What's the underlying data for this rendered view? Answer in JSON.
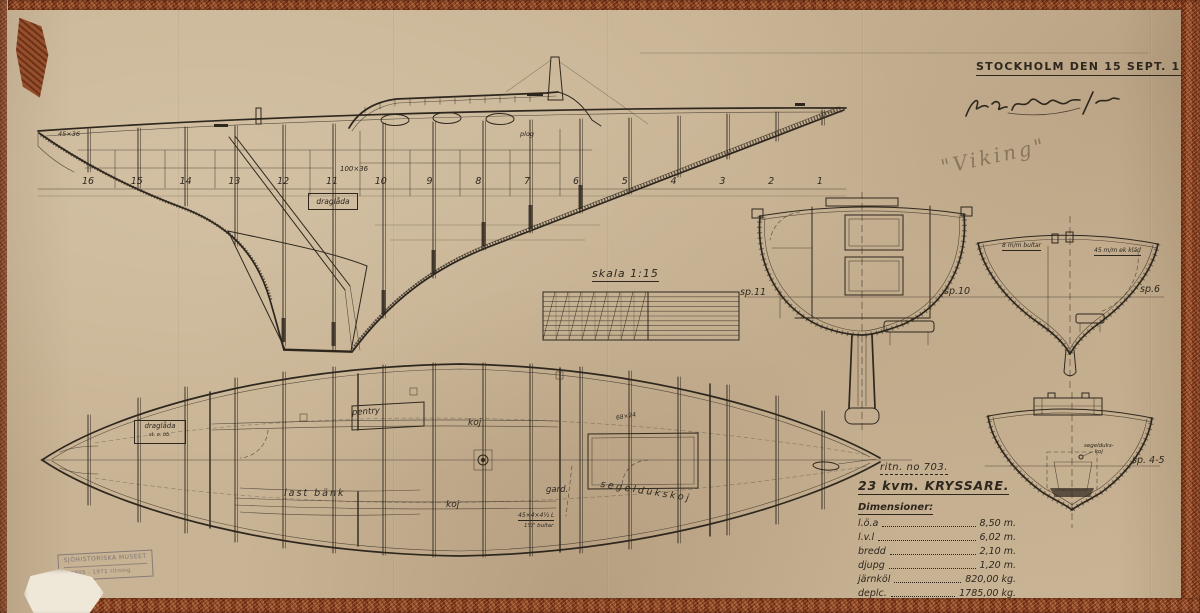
{
  "title_block": {
    "date_line": "STOCKHOLM DEN 15 SEPT. 1944",
    "pencil_note": "\"Viking\""
  },
  "scale": {
    "label": "skala 1:15"
  },
  "profile": {
    "frame_numbers": [
      "16",
      "15",
      "14",
      "13",
      "12",
      "11",
      "10",
      "9",
      "8",
      "7",
      "6",
      "5",
      "4",
      "3",
      "2",
      "1"
    ],
    "draglada_label": "draglåda",
    "deck_dim": "100×36",
    "bow_dim": "45×36",
    "plog_label": "plog"
  },
  "sections": {
    "sp11": "sp.11",
    "sp10": "sp.10",
    "sp6": "sp.6",
    "sp45": "sp. 4-5",
    "bultar_note": "8 m/m bultar",
    "ekklad_note": "45 m/m ek kläd",
    "segelduks_line1": "segelduks-",
    "segelduks_line2": "koj"
  },
  "plan": {
    "pentry": "pentry",
    "koj_fwd": "koj",
    "koj_aft": "koj",
    "last_bank": "last bänk",
    "gard": "gard.",
    "segeldukskoj": "segeldukskoj",
    "draglada": "draglåda",
    "draglada_sub": "st. o. bb.",
    "dim_note1": "45×4×4½ L",
    "dim_note2": "1½\" bultar",
    "frame_dim": "68×24"
  },
  "info_block": {
    "drawing_no": "ritn. no 703.",
    "boat_type": "23 kvm. KRYSSARE.",
    "dim_heading": "Dimensioner:",
    "rows": [
      {
        "label": "l.ö.a",
        "value": "8,50 m."
      },
      {
        "label": "l.v.l",
        "value": "6,02 m."
      },
      {
        "label": "bredd",
        "value": "2,10 m."
      },
      {
        "label": "djupg",
        "value": "1,20 m."
      },
      {
        "label": "järnköl",
        "value": "820,00 kg."
      },
      {
        "label": "deplc.",
        "value": "1785,00 kg."
      }
    ]
  },
  "stamp": {
    "line1": "SJÖHISTORISKA MUSEET",
    "line2": "S 2805 · 1971 ritning"
  },
  "colors": {
    "paper": "#c8b394",
    "ink": "#2e271e",
    "tape": "#8d4827",
    "pencil": "#64584a"
  }
}
